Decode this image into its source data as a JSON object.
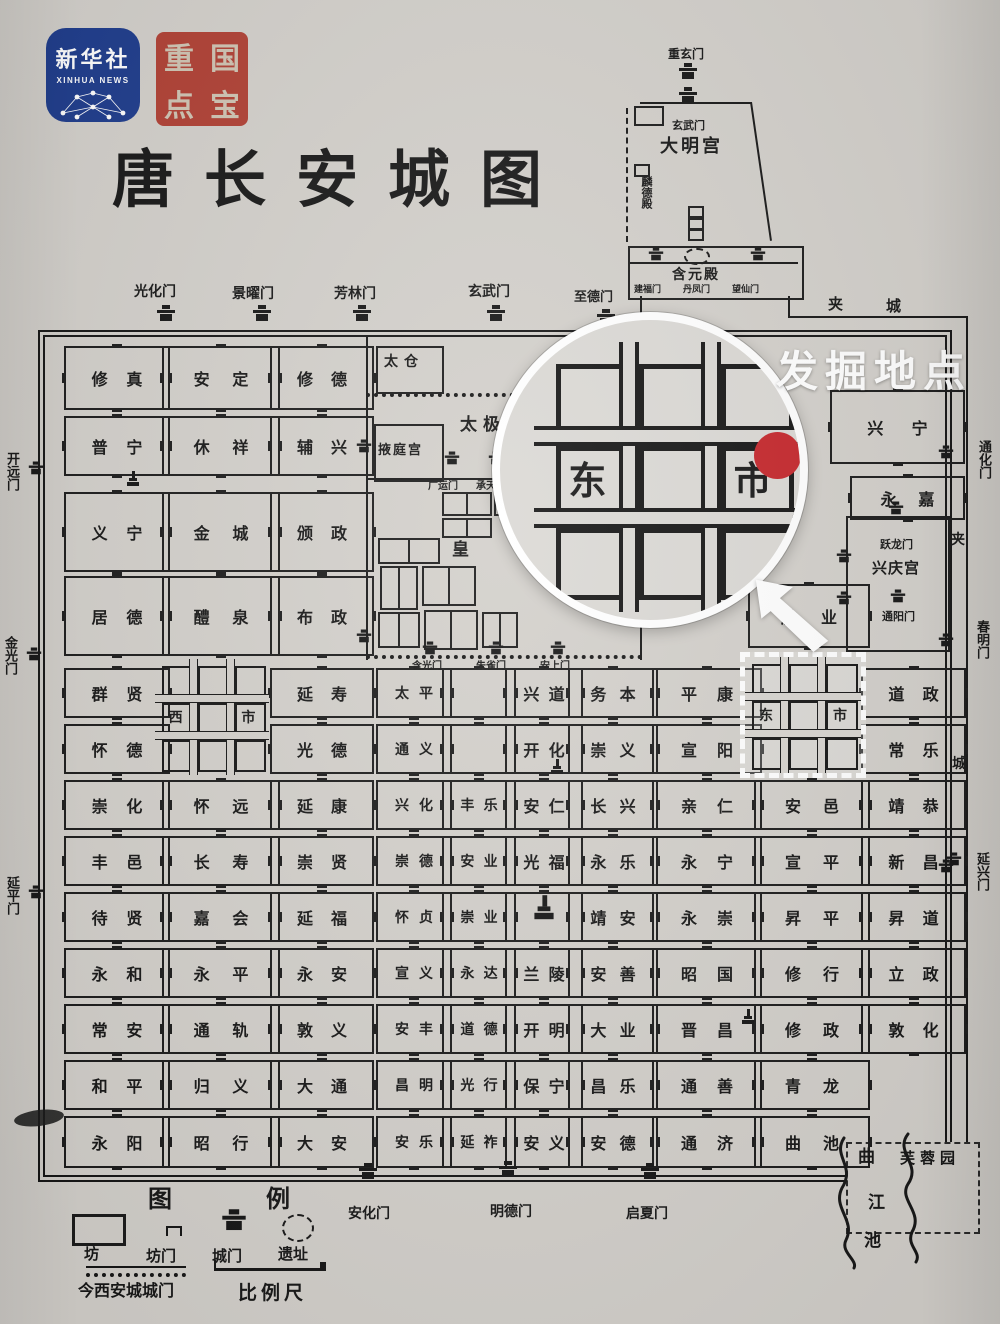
{
  "branding": {
    "logo_line1": "新华社",
    "logo_line2": "XINHUA NEWS",
    "seal_chars": [
      "重",
      "国",
      "点",
      "宝"
    ]
  },
  "title": "唐长安城图",
  "callout": {
    "label": "发掘地点"
  },
  "markets": {
    "west": {
      "c1": "西",
      "c2": "市"
    },
    "east": {
      "c1": "东",
      "c2": "市"
    },
    "magnified": {
      "c1": "东",
      "c2": "市"
    }
  },
  "daming": {
    "top_gate": "重玄门",
    "north_gate": "玄武门",
    "name": "大明宫",
    "linde": "麟德殿",
    "hanyuan": "含元殿",
    "south_gates": [
      "建福门",
      "丹凤门",
      "望仙门"
    ]
  },
  "taiji": {
    "taicang": "太仓",
    "yeting": "掖庭宫",
    "name": "太极宫",
    "gate_left": "广运门",
    "gate_right": "承天门",
    "imperial": "皇"
  },
  "xingqing": {
    "gate_top": "跃龙门",
    "name": "兴庆宫",
    "gate_bottom": "通阳门"
  },
  "gates": {
    "top": [
      "光化门",
      "景曜门",
      "芳林门",
      "玄武门",
      "至德门"
    ],
    "left": [
      "开远门",
      "金光门",
      "延平门"
    ],
    "right": [
      "通化门",
      "春明门",
      "延兴门"
    ],
    "bottom": [
      "安化门",
      "明德门",
      "启夏门"
    ],
    "street": [
      "含光门",
      "朱雀门",
      "安上门"
    ]
  },
  "jiacheng": {
    "top1": "夹",
    "top2": "城",
    "side1": "夹",
    "side2": "城"
  },
  "landmarks": {
    "furong": "芙蓉园",
    "qu": "曲",
    "jiang": "江",
    "chi": "池"
  },
  "legend": {
    "title": "图 例",
    "ward": "坊",
    "ward_gate": "坊门",
    "city_gate": "城门",
    "ruins": "遗址",
    "modern_wall": "今西安城城门",
    "scale": "比例尺"
  },
  "wards": [
    {
      "n": "修真",
      "c": 1,
      "r": 1
    },
    {
      "n": "安定",
      "c": 2,
      "r": 1
    },
    {
      "n": "修德",
      "c": 3,
      "r": 1
    },
    {
      "n": "普宁",
      "c": 1,
      "r": 2
    },
    {
      "n": "休祥",
      "c": 2,
      "r": 2
    },
    {
      "n": "辅兴",
      "c": 3,
      "r": 2
    },
    {
      "n": "义宁",
      "c": 1,
      "r": 3,
      "i": "pagoda-top"
    },
    {
      "n": "金城",
      "c": 2,
      "r": 3
    },
    {
      "n": "颁政",
      "c": 3,
      "r": 3
    },
    {
      "n": "居德",
      "c": 1,
      "r": 4
    },
    {
      "n": "醴泉",
      "c": 2,
      "r": 4
    },
    {
      "n": "布政",
      "c": 3,
      "r": 4
    },
    {
      "n": "群贤",
      "c": 1,
      "r": 5
    },
    {
      "n": "怀德",
      "c": 1,
      "r": 6
    },
    {
      "n": "崇化",
      "c": 1,
      "r": 7
    },
    {
      "n": "丰邑",
      "c": 1,
      "r": 8
    },
    {
      "n": "待贤",
      "c": 1,
      "r": 9
    },
    {
      "n": "永和",
      "c": 1,
      "r": 10
    },
    {
      "n": "常安",
      "c": 1,
      "r": 11
    },
    {
      "n": "和平",
      "c": 1,
      "r": 12
    },
    {
      "n": "永阳",
      "c": 1,
      "r": 13
    },
    {
      "n": "怀远",
      "c": 2,
      "r": 7
    },
    {
      "n": "长寿",
      "c": 2,
      "r": 8
    },
    {
      "n": "嘉会",
      "c": 2,
      "r": 9
    },
    {
      "n": "永平",
      "c": 2,
      "r": 10
    },
    {
      "n": "通轨",
      "c": 2,
      "r": 11
    },
    {
      "n": "归义",
      "c": 2,
      "r": 12
    },
    {
      "n": "昭行",
      "c": 2,
      "r": 13
    },
    {
      "n": "延寿",
      "c": 3,
      "r": 5
    },
    {
      "n": "光德",
      "c": 3,
      "r": 6
    },
    {
      "n": "延康",
      "c": 3,
      "r": 7
    },
    {
      "n": "崇贤",
      "c": 3,
      "r": 8
    },
    {
      "n": "延福",
      "c": 3,
      "r": 9
    },
    {
      "n": "永安",
      "c": 3,
      "r": 10
    },
    {
      "n": "敦义",
      "c": 3,
      "r": 11
    },
    {
      "n": "大通",
      "c": 3,
      "r": 12
    },
    {
      "n": "大安",
      "c": 3,
      "r": 13
    },
    {
      "n": "太平",
      "c": 4,
      "r": 5
    },
    {
      "n": "通义",
      "c": 4,
      "r": 6
    },
    {
      "n": "兴化",
      "c": 4,
      "r": 7
    },
    {
      "n": "崇德",
      "c": 4,
      "r": 8
    },
    {
      "n": "怀贞",
      "c": 4,
      "r": 9
    },
    {
      "n": "宣义",
      "c": 4,
      "r": 10
    },
    {
      "n": "安丰",
      "c": 4,
      "r": 11
    },
    {
      "n": "昌明",
      "c": 4,
      "r": 12
    },
    {
      "n": "安乐",
      "c": 4,
      "r": 13
    },
    {
      "n": "",
      "c": 5,
      "r": 5
    },
    {
      "n": "",
      "c": 5,
      "r": 6
    },
    {
      "n": "丰乐",
      "c": 5,
      "r": 7
    },
    {
      "n": "安业",
      "c": 5,
      "r": 8
    },
    {
      "n": "崇业",
      "c": 5,
      "r": 9
    },
    {
      "n": "永达",
      "c": 5,
      "r": 10
    },
    {
      "n": "道德",
      "c": 5,
      "r": 11
    },
    {
      "n": "光行",
      "c": 5,
      "r": 12
    },
    {
      "n": "延祚",
      "c": 5,
      "r": 13
    },
    {
      "n": "兴道",
      "c": 6,
      "r": 5
    },
    {
      "n": "开化",
      "c": 6,
      "r": 6
    },
    {
      "n": "安仁",
      "c": 6,
      "r": 7,
      "i": "pagoda-top"
    },
    {
      "n": "光福",
      "c": 6,
      "r": 8
    },
    {
      "n": "",
      "c": 6,
      "r": 9,
      "i": "temple"
    },
    {
      "n": "兰陵",
      "c": 6,
      "r": 10
    },
    {
      "n": "开明",
      "c": 6,
      "r": 11
    },
    {
      "n": "保宁",
      "c": 6,
      "r": 12
    },
    {
      "n": "安义",
      "c": 6,
      "r": 13
    },
    {
      "n": "务本",
      "c": 7,
      "r": 5
    },
    {
      "n": "崇义",
      "c": 7,
      "r": 6
    },
    {
      "n": "长兴",
      "c": 7,
      "r": 7
    },
    {
      "n": "永乐",
      "c": 7,
      "r": 8
    },
    {
      "n": "靖安",
      "c": 7,
      "r": 9
    },
    {
      "n": "安善",
      "c": 7,
      "r": 10
    },
    {
      "n": "大业",
      "c": 7,
      "r": 11
    },
    {
      "n": "昌乐",
      "c": 7,
      "r": 12
    },
    {
      "n": "安德",
      "c": 7,
      "r": 13
    },
    {
      "n": "平康",
      "c": 8,
      "r": 5
    },
    {
      "n": "宣阳",
      "c": 8,
      "r": 6
    },
    {
      "n": "亲仁",
      "c": 8,
      "r": 7
    },
    {
      "n": "永宁",
      "c": 8,
      "r": 8
    },
    {
      "n": "永崇",
      "c": 8,
      "r": 9
    },
    {
      "n": "昭国",
      "c": 8,
      "r": 10
    },
    {
      "n": "晋昌",
      "c": 8,
      "r": 11,
      "i": "pagoda"
    },
    {
      "n": "通善",
      "c": 8,
      "r": 12
    },
    {
      "n": "通济",
      "c": 8,
      "r": 13
    },
    {
      "n": "安邑",
      "c": 9,
      "r": 7
    },
    {
      "n": "宣平",
      "c": 9,
      "r": 8
    },
    {
      "n": "昇平",
      "c": 9,
      "r": 9
    },
    {
      "n": "修行",
      "c": 9,
      "r": 10
    },
    {
      "n": "修政",
      "c": 9,
      "r": 11
    },
    {
      "n": "青龙",
      "c": 9,
      "r": 12
    },
    {
      "n": "曲池",
      "c": 9,
      "r": 13
    },
    {
      "n": "道政",
      "c": 10,
      "r": 5
    },
    {
      "n": "常乐",
      "c": 10,
      "r": 6
    },
    {
      "n": "靖恭",
      "c": 10,
      "r": 7
    },
    {
      "n": "新昌",
      "c": 10,
      "r": 8,
      "i": "gate"
    },
    {
      "n": "昇道",
      "c": 10,
      "r": 9
    },
    {
      "n": "立政",
      "c": 10,
      "r": 10
    },
    {
      "n": "敦化",
      "c": 10,
      "r": 11
    },
    {
      "n": "胜业",
      "c": 9,
      "r": "4e"
    },
    {
      "n": "兴宁",
      "c": "xr",
      "r": "x1"
    },
    {
      "n": "永嘉",
      "c": "xr",
      "r": "x2"
    }
  ]
}
